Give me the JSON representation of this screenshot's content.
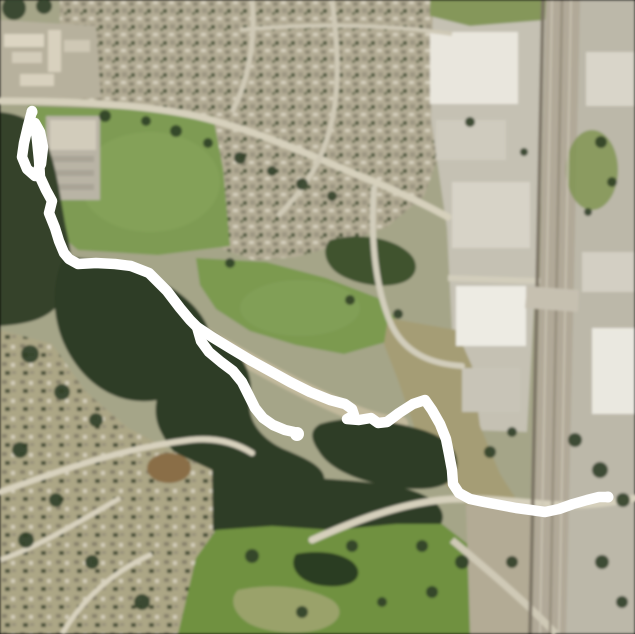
{
  "view": {
    "kind": "aerial-satellite-map-with-gps-route",
    "width": 635,
    "height": 634
  },
  "map": {
    "background": "#a5a588",
    "tree_color": "#2f3f27",
    "layers": [
      {
        "n": "residential-area-north",
        "t": "polygon",
        "a": {
          "points": "60,0 458,0 455,62 447,132 424,196 388,226 342,244 296,257 254,260 224,250 204,222 196,150 160,109 98,101 60,99",
          "fill": "url(#housesA)"
        }
      },
      {
        "n": "apartment-complex-block",
        "t": "polygon",
        "a": {
          "points": "0,20 96,26 101,98 0,103",
          "fill": "#b7b19d"
        }
      },
      {
        "n": "apartment-building",
        "t": "rect",
        "a": {
          "x": 4,
          "y": 34,
          "width": 40,
          "height": 13,
          "fill": "#dcd5c2"
        }
      },
      {
        "n": "apartment-building",
        "t": "rect",
        "a": {
          "x": 12,
          "y": 52,
          "width": 30,
          "height": 11,
          "fill": "#d3ccb9"
        }
      },
      {
        "n": "apartment-building",
        "t": "rect",
        "a": {
          "x": 48,
          "y": 30,
          "width": 13,
          "height": 42,
          "fill": "#d8d1be"
        }
      },
      {
        "n": "apartment-building",
        "t": "rect",
        "a": {
          "x": 20,
          "y": 74,
          "width": 34,
          "height": 12,
          "fill": "#d8d1be"
        }
      },
      {
        "n": "apartment-building",
        "t": "rect",
        "a": {
          "x": 64,
          "y": 40,
          "width": 26,
          "height": 12,
          "fill": "#cfc8b5"
        }
      },
      {
        "n": "commercial-district-west",
        "t": "polygon",
        "a": {
          "points": "433,0 546,0 541,200 534,305 527,432 468,430 452,330 447,228 431,120",
          "fill": "#c5c1b3"
        }
      },
      {
        "n": "green-strip-northeast",
        "t": "polygon",
        "a": {
          "points": "430,0 546,0 545,20 470,26 430,16",
          "fill": "#85975a"
        }
      },
      {
        "n": "highway-corridor",
        "t": "polygon",
        "a": {
          "points": "546,0 580,0 566,634 532,634",
          "fill": "#b1a998"
        }
      },
      {
        "n": "commercial-district-east",
        "t": "polygon",
        "a": {
          "points": "580,0 635,0 635,634 566,634",
          "fill": "#bcb8a9"
        }
      },
      {
        "n": "sports-field",
        "t": "polygon",
        "a": {
          "points": "28,106 150,110 213,116 223,168 230,246 158,255 78,250 40,218 29,162",
          "fill": "#7e9b53"
        }
      },
      {
        "n": "sports-field-light-patch",
        "t": "ellipse",
        "a": {
          "cx": 150,
          "cy": 182,
          "rx": 70,
          "ry": 50,
          "fill": "#88a65f",
          "opacity": 0.55
        }
      },
      {
        "n": "parking-lot-northwest",
        "t": "rect",
        "a": {
          "x": 46,
          "y": 116,
          "width": 54,
          "height": 84,
          "fill": "#b9b4a5"
        }
      },
      {
        "n": "school-building",
        "t": "rect",
        "a": {
          "x": 50,
          "y": 120,
          "width": 46,
          "height": 30,
          "fill": "#d2ccbb"
        }
      },
      {
        "n": "parking-row",
        "t": "rect",
        "a": {
          "x": 52,
          "y": 156,
          "width": 42,
          "height": 6,
          "fill": "#a9a496"
        }
      },
      {
        "n": "parking-row",
        "t": "rect",
        "a": {
          "x": 52,
          "y": 170,
          "width": 42,
          "height": 6,
          "fill": "#a9a496"
        }
      },
      {
        "n": "parking-row",
        "t": "rect",
        "a": {
          "x": 52,
          "y": 184,
          "width": 42,
          "height": 6,
          "fill": "#a9a496"
        }
      },
      {
        "n": "forest-west",
        "t": "path",
        "a": {
          "d": "M0,112 C20,114 34,120 44,138 C56,160 60,195 66,228 C72,255 74,268 64,295 C54,318 30,324 0,326 Z",
          "fill": "#34422a"
        }
      },
      {
        "n": "meadow-central",
        "t": "polygon",
        "a": {
          "points": "196,258 266,262 326,278 378,298 396,320 386,342 344,354 296,345 250,331 216,309 200,285",
          "fill": "#7b9a50"
        }
      },
      {
        "n": "meadow-light-patch",
        "t": "ellipse",
        "a": {
          "cx": 300,
          "cy": 308,
          "rx": 60,
          "ry": 28,
          "fill": "#87a45c",
          "opacity": 0.5
        }
      },
      {
        "n": "field-southeast",
        "t": "polygon",
        "a": {
          "points": "388,318 456,330 472,366 480,426 500,474 518,502 466,504 438,478 418,438 398,380 384,344",
          "fill": "#a59d74"
        }
      },
      {
        "n": "tree-row-northeast-of-meadow",
        "t": "path",
        "a": {
          "d": "M330,240 C360,232 392,238 408,252 C420,262 418,276 404,282 C384,290 352,284 336,272 C324,262 322,248 330,240 Z",
          "fill": "#41522f"
        }
      },
      {
        "n": "dirt-trail-diagonal",
        "t": "path",
        "a": {
          "d": "M196,330 C246,360 300,390 352,412 C372,420 386,424 400,424",
          "fill": "none",
          "stroke": "#c6bda0",
          "stroke-width": 16,
          "stroke-linecap": "round",
          "opacity": 0.9
        }
      },
      {
        "n": "forest-central-blob",
        "t": "path",
        "a": {
          "d": "M64,256 C104,260 142,268 172,288 C202,308 216,332 210,356 C204,380 184,396 158,400 C118,407 84,384 66,348 C52,320 50,284 64,256 Z",
          "fill": "#2e3d26"
        }
      },
      {
        "n": "forest-ravine-blob",
        "t": "path",
        "a": {
          "d": "M206,328 C236,344 256,370 250,398 C246,420 262,440 286,450 C312,461 332,470 322,490 C312,508 272,506 240,496 C204,484 174,460 160,430 C148,404 162,378 182,358 Z",
          "fill": "#2e3d26"
        }
      },
      {
        "n": "forest-east-blob",
        "t": "path",
        "a": {
          "d": "M320,424 C352,414 386,420 416,428 C446,436 462,450 456,472 C451,490 420,492 388,486 C354,480 328,468 318,450 C310,438 310,430 320,424 Z",
          "fill": "#2e3d26"
        }
      },
      {
        "n": "forest-south-band",
        "t": "path",
        "a": {
          "d": "M212,470 C262,478 322,476 382,484 C422,489 448,504 442,522 C436,538 396,540 350,541 C300,542 252,545 222,534 C197,526 192,504 197,488 Z",
          "fill": "#2e3d26"
        }
      },
      {
        "n": "residential-area-southwest",
        "t": "polygon",
        "a": {
          "points": "0,330 52,344 86,392 128,428 182,456 212,470 213,548 196,560 178,634 0,634",
          "fill": "url(#housesB)"
        }
      },
      {
        "n": "golf-course",
        "t": "polygon",
        "a": {
          "points": "196,558 216,530 272,526 332,530 396,524 442,524 470,546 470,634 178,634",
          "fill": "#6f9140"
        }
      },
      {
        "n": "golf-dark-rough",
        "t": "path",
        "a": {
          "d": "M296,554 C326,548 354,556 358,570 C361,584 340,589 318,585 C298,581 288,566 296,554 Z",
          "fill": "#2c3c22"
        }
      },
      {
        "n": "golf-tan-fairway",
        "t": "path",
        "a": {
          "d": "M238,590 C274,582 312,588 332,600 C346,610 340,624 318,630 C294,636 258,632 244,620 C232,610 230,598 238,590 Z",
          "fill": "#9aa26b"
        }
      },
      {
        "n": "dirt-patch",
        "t": "ellipse",
        "a": {
          "cx": 169,
          "cy": 468,
          "rx": 22,
          "ry": 15,
          "fill": "#8a6e46"
        }
      },
      {
        "n": "lowland-southeast",
        "t": "polygon",
        "a": {
          "points": "466,504 533,506 528,634 470,634",
          "fill": "#b3ab95"
        }
      },
      {
        "n": "big-box-store",
        "t": "rect",
        "a": {
          "x": 430,
          "y": 32,
          "width": 88,
          "height": 72,
          "fill": "#e9e6dd"
        }
      },
      {
        "n": "commercial-building",
        "t": "rect",
        "a": {
          "x": 436,
          "y": 120,
          "width": 70,
          "height": 40,
          "fill": "#cfcbbe"
        }
      },
      {
        "n": "commercial-building",
        "t": "rect",
        "a": {
          "x": 452,
          "y": 182,
          "width": 78,
          "height": 66,
          "fill": "#d7d3c7"
        }
      },
      {
        "n": "big-box-store",
        "t": "rect",
        "a": {
          "x": 456,
          "y": 286,
          "width": 70,
          "height": 60,
          "fill": "#edebe3"
        }
      },
      {
        "n": "parking-structure",
        "t": "rect",
        "a": {
          "x": 462,
          "y": 368,
          "width": 58,
          "height": 44,
          "fill": "#c8c4b7"
        }
      },
      {
        "n": "commercial-building-east",
        "t": "rect",
        "a": {
          "x": 586,
          "y": 52,
          "width": 48,
          "height": 54,
          "fill": "#d9d5c9"
        }
      },
      {
        "n": "green-patch-east",
        "t": "ellipse",
        "a": {
          "cx": 592,
          "cy": 170,
          "rx": 26,
          "ry": 40,
          "fill": "#7e944f",
          "opacity": 0.8
        }
      },
      {
        "n": "commercial-building-east",
        "t": "rect",
        "a": {
          "x": 582,
          "y": 252,
          "width": 52,
          "height": 40,
          "fill": "#d3cfc3"
        }
      },
      {
        "n": "warehouse-east",
        "t": "rect",
        "a": {
          "x": 592,
          "y": 328,
          "width": 43,
          "height": 86,
          "fill": "#eae8e0"
        }
      },
      {
        "n": "road-main-curve",
        "t": "path",
        "a": {
          "d": "M0,101 C70,101 140,104 196,116 C256,130 310,155 360,176 C396,190 422,203 448,217",
          "fill": "none",
          "stroke": "#d6d0bc",
          "stroke-width": 7,
          "stroke-linecap": "round"
        }
      },
      {
        "n": "street-north-1",
        "t": "path",
        "a": {
          "d": "M252,0 C256,40 248,82 232,112",
          "fill": "none",
          "stroke": "#cfc9b6",
          "stroke-width": 5
        }
      },
      {
        "n": "street-north-2",
        "t": "path",
        "a": {
          "d": "M332,0 C338,46 342,96 326,142 C316,172 298,196 278,216",
          "fill": "none",
          "stroke": "#cfc9b6",
          "stroke-width": 5
        }
      },
      {
        "n": "street-north-3",
        "t": "path",
        "a": {
          "d": "M240,30 C320,22 400,26 452,34",
          "fill": "none",
          "stroke": "#cfc9b6",
          "stroke-width": 4
        }
      },
      {
        "n": "street-east-curve",
        "t": "path",
        "a": {
          "d": "M374,188 C370,240 376,292 392,326 C406,354 432,364 462,366",
          "fill": "none",
          "stroke": "#d2cdbb",
          "stroke-width": 6,
          "stroke-linecap": "round"
        }
      },
      {
        "n": "road-commercial-crossing",
        "t": "path",
        "a": {
          "d": "M448,278 L540,281",
          "fill": "none",
          "stroke": "#d2cdbb",
          "stroke-width": 6
        }
      },
      {
        "n": "road-south-eastwest",
        "t": "path",
        "a": {
          "d": "M312,540 C352,522 396,505 440,500 C482,496 520,503 560,505 C592,506 616,502 635,498",
          "fill": "none",
          "stroke": "#d6d0bc",
          "stroke-width": 7,
          "stroke-linecap": "round"
        }
      },
      {
        "n": "road-bottomright-diagonal",
        "t": "path",
        "a": {
          "d": "M452,540 C490,572 526,602 556,634",
          "fill": "none",
          "stroke": "#cfc9b6",
          "stroke-width": 7
        }
      },
      {
        "n": "street-southwest-1",
        "t": "path",
        "a": {
          "d": "M0,492 C62,470 122,448 190,440 C216,437 236,443 252,453",
          "fill": "none",
          "stroke": "#d8d2be",
          "stroke-width": 6,
          "stroke-linecap": "round"
        }
      },
      {
        "n": "street-southwest-2",
        "t": "path",
        "a": {
          "d": "M0,560 C42,545 82,520 120,498",
          "fill": "none",
          "stroke": "#d8d2be",
          "stroke-width": 5
        }
      },
      {
        "n": "street-southwest-3",
        "t": "path",
        "a": {
          "d": "M62,634 C82,600 112,572 152,554",
          "fill": "none",
          "stroke": "#d8d2be",
          "stroke-width": 5
        }
      },
      {
        "n": "railroad-line",
        "t": "path",
        "a": {
          "d": "M543,0 L530,634",
          "fill": "none",
          "stroke": "#7a7263",
          "stroke-width": 3.5
        }
      },
      {
        "n": "highway-lane-line",
        "t": "path",
        "a": {
          "d": "M552,0 L540,634",
          "fill": "none",
          "stroke": "#cdc7b6",
          "stroke-width": 1.5
        }
      },
      {
        "n": "highway-median",
        "t": "path",
        "a": {
          "d": "M562,0 L550,634",
          "fill": "none",
          "stroke": "#968e7d",
          "stroke-width": 2.5
        }
      },
      {
        "n": "highway-lane-line",
        "t": "path",
        "a": {
          "d": "M571,0 L559,634",
          "fill": "none",
          "stroke": "#cdc7b6",
          "stroke-width": 1.5
        }
      },
      {
        "n": "highway-overpass",
        "t": "polygon",
        "a": {
          "points": "527,286 579,290 578,312 525,308",
          "fill": "#c6c0b0"
        }
      }
    ],
    "trees": [
      [
        14,
        8,
        12
      ],
      [
        44,
        6,
        8
      ],
      [
        105,
        116,
        6
      ],
      [
        146,
        121,
        5
      ],
      [
        176,
        131,
        6
      ],
      [
        208,
        143,
        5
      ],
      [
        240,
        158,
        6
      ],
      [
        272,
        171,
        5
      ],
      [
        302,
        184,
        6
      ],
      [
        332,
        196,
        5
      ],
      [
        230,
        263,
        5
      ],
      [
        350,
        300,
        5
      ],
      [
        398,
        314,
        5
      ],
      [
        470,
        122,
        5
      ],
      [
        524,
        152,
        4
      ],
      [
        601,
        142,
        6
      ],
      [
        612,
        182,
        5
      ],
      [
        588,
        212,
        4
      ],
      [
        252,
        556,
        7
      ],
      [
        352,
        546,
        6
      ],
      [
        422,
        546,
        6
      ],
      [
        462,
        562,
        7
      ],
      [
        302,
        612,
        6
      ],
      [
        382,
        602,
        5
      ],
      [
        432,
        592,
        6
      ],
      [
        512,
        562,
        6
      ],
      [
        602,
        562,
        7
      ],
      [
        622,
        602,
        6
      ],
      [
        30,
        354,
        9
      ],
      [
        62,
        392,
        8
      ],
      [
        96,
        420,
        7
      ],
      [
        20,
        450,
        8
      ],
      [
        56,
        500,
        7
      ],
      [
        26,
        540,
        8
      ],
      [
        92,
        562,
        7
      ],
      [
        142,
        602,
        8
      ],
      [
        490,
        452,
        6
      ],
      [
        512,
        432,
        5
      ],
      [
        575,
        440,
        7
      ],
      [
        600,
        470,
        8
      ],
      [
        623,
        500,
        7
      ]
    ]
  },
  "track": {
    "label": "gps-route-overlay",
    "color": "#ffffff",
    "stroke_width": 10.5,
    "main_path": "M32,111 L28,126 L24,143 L22,157 L27,169 L35,176 L41,164 L43,147 L40,132 L35,123 L37,140 L39,160 L40,177 L46,190 L52,201 L49,213 L55,228 L59,241 L64,253 L69,259 L78,264 L96,263 L115,264 L131,266 L149,273 L167,291 L180,308 L190,320 L197,327 L212,337 L230,348 L250,360 L270,371 L290,382 L310,392 L330,400 L345,404 L352,409 L354,415 L347,419 L359,420 L371,418 L378,423 L387,422 L399,413 L413,404 L425,400 L432,410 L440,424 L446,439 L449,454 L452,470 L453,484 L459,493 L470,499 L484,502 L500,505 L516,508 L531,510 L545,512 L559,509 L573,504 L587,500 L599,497 L608,497",
    "branch_path": "M197,327 L201,341 L209,352 L221,362 L233,371 L242,382 L248,394 L255,408 L263,418 L273,425 L285,430 L294,432",
    "branch_endpoint": {
      "cx": 297,
      "cy": 434,
      "r": 7
    },
    "start_point": {
      "cx": 32,
      "cy": 112,
      "r": 5.5
    },
    "end_point": {
      "cx": 608,
      "cy": 497,
      "r": 5.5
    }
  }
}
